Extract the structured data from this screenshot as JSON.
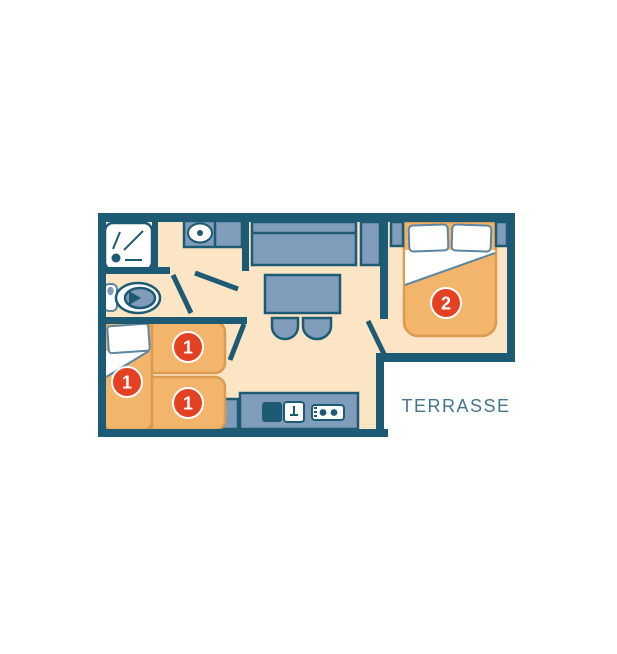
{
  "plan": {
    "terrasse_label": "TERRASSE",
    "bed_badges": {
      "single_left": "1",
      "single_top": "1",
      "single_bottom": "1",
      "double": "2"
    },
    "icons": [
      "shower-icon",
      "toilet-icon",
      "washbasin-icon",
      "sofa-icon",
      "table-icon",
      "stool-icon",
      "fridge-icon",
      "kitchen-sink-icon",
      "stove-icon",
      "bed-icon"
    ],
    "colors": {
      "background": "#ffffff",
      "wall": "#1d5a73",
      "floor": "#fbe5c4",
      "shower_floor": "#e9eef3",
      "furniture": "#7f9dba",
      "bed": "#f3b46b",
      "bed_outline": "#dc9b52",
      "badge": "#e34122",
      "badge_text": "#ffffff",
      "pillow_line": "#5c86a4",
      "label_text": "#44758f"
    }
  }
}
